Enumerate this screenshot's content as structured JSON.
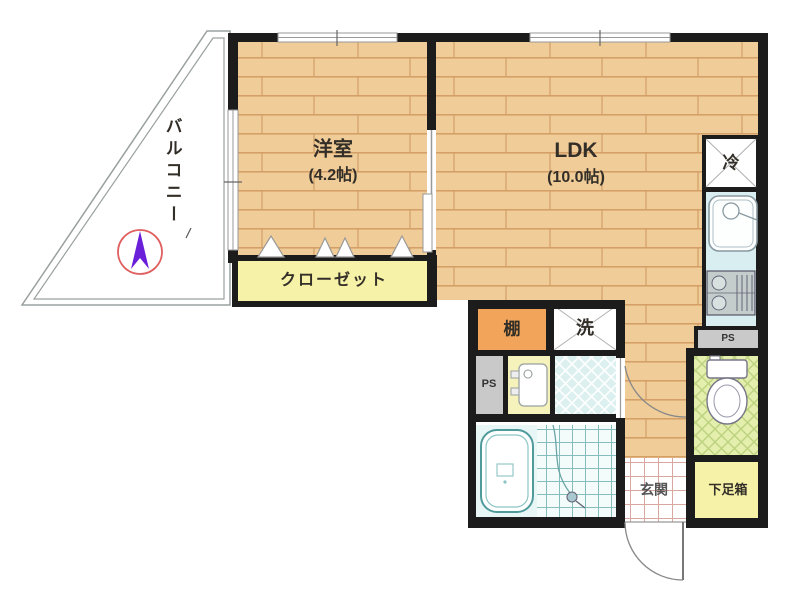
{
  "floorplan": {
    "balcony": {
      "label": "バルコニー"
    },
    "western_room": {
      "label": "洋室",
      "size": "(4.2帖)"
    },
    "ldk": {
      "label": "LDK",
      "size": "(10.0帖)"
    },
    "closet": {
      "label": "クローゼット"
    },
    "shelf": {
      "label": "棚"
    },
    "washer": {
      "label": "洗"
    },
    "fridge": {
      "label": "冷"
    },
    "pipe_space_left": {
      "label": "PS"
    },
    "pipe_space_kitchen": {
      "label": "PS"
    },
    "entrance": {
      "label": "玄関"
    },
    "shoe_cabinet": {
      "label": "下足箱"
    },
    "icons": {
      "compass": "north-arrow"
    },
    "colors": {
      "wall": "#1c1c1c",
      "wood_floor": "#f0cc98",
      "wood_line": "#d09a62",
      "closet_yellow": "#f6f2a8",
      "shelf_orange": "#f2a55a",
      "washroom_cyan": "#ddf0f0",
      "toilet_green": "#e4efae",
      "kitchen_counter": "#d9eef0",
      "ps_gray": "#c9c9c9",
      "bath_tile": "#f4fbfb",
      "compass_ring": "#e06060",
      "compass_needle": "#6a20d8"
    }
  }
}
